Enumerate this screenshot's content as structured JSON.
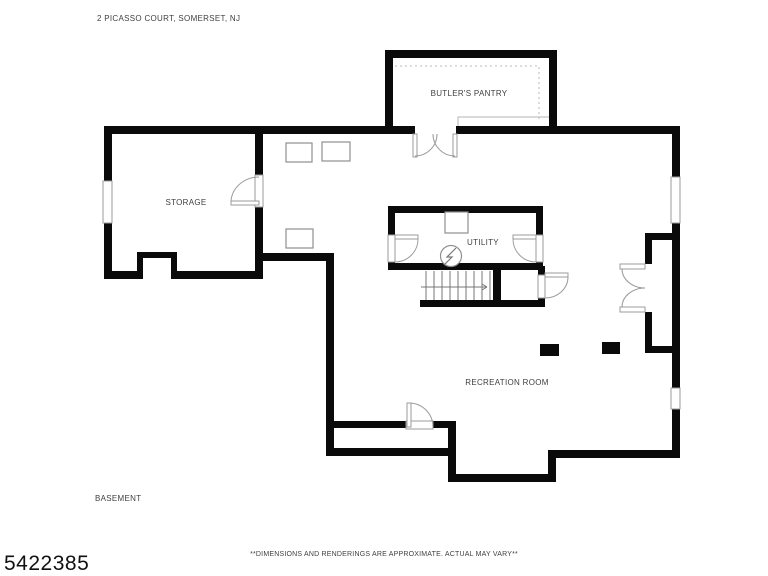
{
  "page": {
    "address": "2 PICASSO COURT, SOMERSET, NJ",
    "floor_label": "BASEMENT",
    "id_number": "5422385",
    "disclaimer": "**DIMENSIONS AND RENDERINGS ARE APPROXIMATE. ACTUAL MAY VARY**"
  },
  "rooms": {
    "butlers_pantry": "BUTLER'S PANTRY",
    "storage": "STORAGE",
    "utility": "UTILITY",
    "recreation_room": "RECREATION ROOM"
  },
  "symbols": {
    "stairs": "staircase-with-direction-arrow",
    "water_heater": "circle-lightning-utility-symbol",
    "columns": 2,
    "windows": 3
  },
  "colors": {
    "background": "#ffffff",
    "wall": "#0a0a0a",
    "thin_line": "#9b9b9b",
    "text": "#3f3f3f",
    "number": "#111111"
  }
}
